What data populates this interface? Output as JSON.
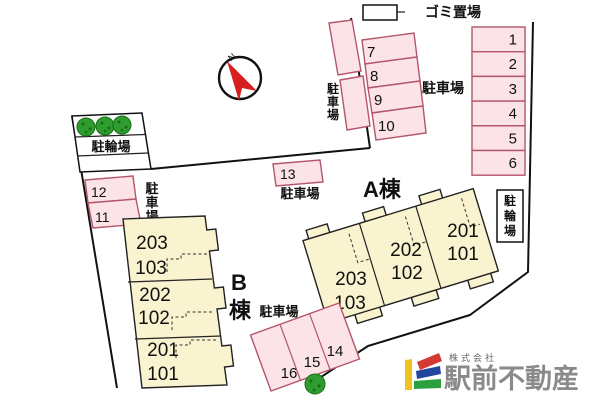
{
  "compass": {
    "north_label": "N"
  },
  "garbage_area": {
    "label": "ゴミ置場"
  },
  "bicycle_parking_left": {
    "label": "駐輪場"
  },
  "bicycle_parking_right": {
    "label_chars": [
      "駐",
      "輪",
      "場"
    ]
  },
  "parking_lots": {
    "upper_left_vertical_chars": [
      "駐",
      "車",
      "場"
    ],
    "upper_label": "駐車場",
    "west_vertical_chars": [
      "駐",
      "車",
      "場"
    ],
    "space13_label": "駐車場",
    "south_label": "駐車場",
    "space_numbers": [
      "1",
      "2",
      "3",
      "4",
      "5",
      "6",
      "7",
      "8",
      "9",
      "10",
      "11",
      "12",
      "13",
      "14",
      "15",
      "16"
    ]
  },
  "building_a": {
    "name": "A棟",
    "units": [
      "203",
      "103",
      "202",
      "102",
      "201",
      "101"
    ]
  },
  "building_b": {
    "name_chars": [
      "B",
      "棟"
    ],
    "units": [
      "203",
      "103",
      "202",
      "102",
      "201",
      "101"
    ]
  },
  "logo": {
    "company_type": "株式会社",
    "company_name": "駅前不動産"
  },
  "colors": {
    "space_fill": "#fbe3e8",
    "space_border": "#b4566a",
    "building_fill": "#faf3cf",
    "tree_green": "#2e9c2e",
    "compass_red": "#d81f1f",
    "logo_text_gray": "#8a8a8a",
    "logo_yellow": "#f0c420",
    "logo_red": "#d43a34",
    "logo_blue": "#23479e",
    "logo_green": "#2aa03e"
  }
}
